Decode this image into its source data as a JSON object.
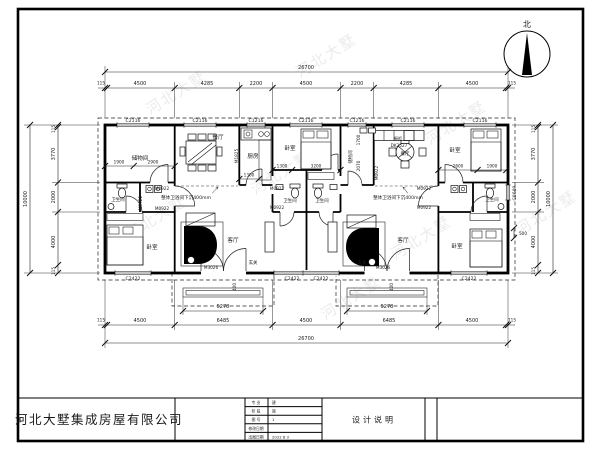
{
  "compass": {
    "north_label": "北"
  },
  "dims": {
    "top_total": "26700",
    "bottom_total": "26700",
    "top_chain": [
      "115",
      "4500",
      "4285",
      "2200",
      "4500",
      "2200",
      "4285",
      "4500",
      "115"
    ],
    "bottom_chain": [
      "115",
      "4500",
      "6485",
      "4500",
      "6485",
      "4500",
      "115"
    ],
    "left_chain": [
      "115",
      "3770",
      "2000",
      "4000",
      "115"
    ],
    "right_chain": [
      "115",
      "3770",
      "2000",
      "4000",
      "115"
    ],
    "left_total": "10000",
    "right_total": "10000",
    "porch_width": "5278",
    "interior": {
      "storage_a": "1900",
      "storage_b": "2900",
      "kitchen_w": "1300",
      "bed_n_a": "1300",
      "bed_n_b": "3200",
      "bed_ne_a": "2600",
      "bed_ne_b": "1900",
      "corridor_a": "1700",
      "corridor_b": "2070",
      "offset": "500",
      "step": "400"
    }
  },
  "windows": {
    "c2116": "C2116",
    "c1216": "C1216",
    "c2422": "C2422",
    "c0609": "C0609"
  },
  "doors": {
    "m0922": "M0922",
    "m1825": "M1825",
    "m3026": "M3026"
  },
  "rooms": {
    "storage": "储物间",
    "dining": "餐厅",
    "kitchen": "厨房",
    "bedroom": "卧室",
    "bath": "卫生间",
    "living": "客厅",
    "entry": "玄关",
    "cabinet": "橱柜",
    "cabinet_model": "DK2527"
  },
  "annotations": {
    "sunken": "整体卫浴间下沉400mm",
    "watermark": "河北大墅"
  },
  "title_block": {
    "company": "河北大墅集成房屋有限公司",
    "drawing_title": "设计说明",
    "fields": [
      {
        "label": "专 业",
        "value": "建"
      },
      {
        "label": "阶 段",
        "value": "施"
      },
      {
        "label": "图 号",
        "value": "1"
      },
      {
        "label": "修改日期",
        "value": ""
      },
      {
        "label": "出图日期",
        "value": "2022  8  3"
      }
    ]
  }
}
